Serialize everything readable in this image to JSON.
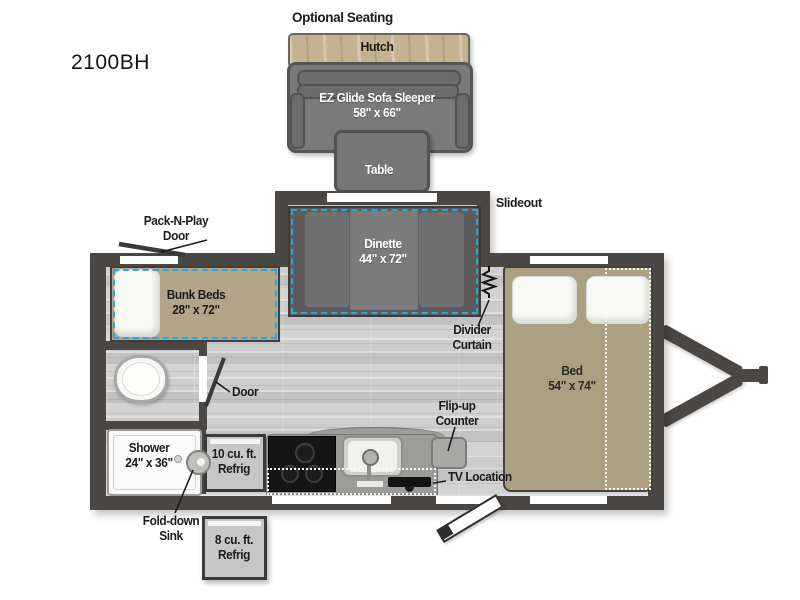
{
  "model": "2100BH",
  "optional_seating": {
    "label": "Optional Seating",
    "hutch_label": "Hutch",
    "sofa_label_line1": "EZ Glide Sofa Sleeper",
    "sofa_label_line2": "58\" x 66\"",
    "table_label": "Table"
  },
  "floorplan": {
    "slideout_label": "Slideout",
    "dinette": {
      "name": "Dinette",
      "dims": "44\" x 72\""
    },
    "bunk_beds": {
      "name": "Bunk Beds",
      "dims": "28\" x 72\""
    },
    "bed": {
      "name": "Bed",
      "dims": "54\" x 74\""
    },
    "shower": {
      "name": "Shower",
      "dims": "24\" x 36\""
    },
    "refrig_10": {
      "line1": "10 cu. ft.",
      "line2": "Refrig"
    },
    "refrig_8": {
      "line1": "8 cu. ft.",
      "line2": "Refrig"
    },
    "callouts": {
      "pack_n_play": {
        "line1": "Pack-N-Play",
        "line2": "Door"
      },
      "interior_door": "Door",
      "divider_curtain": {
        "line1": "Divider",
        "line2": "Curtain"
      },
      "flip_up_counter": {
        "line1": "Flip-up",
        "line2": "Counter"
      },
      "tv_location": "TV Location",
      "fold_down_sink": {
        "line1": "Fold-down",
        "line2": "Sink"
      }
    }
  },
  "colors": {
    "wall": "#4a4745",
    "accent_dash_blue": "#2aa7de",
    "bed_tan": "#aca083",
    "bunk_tan": "#b2a58a",
    "hutch_wood": "#c4b392",
    "sofa_gray": "#7a7a7a",
    "dinette_gray": "#5b5b5b",
    "floor_gray": "#c9c9c9"
  }
}
